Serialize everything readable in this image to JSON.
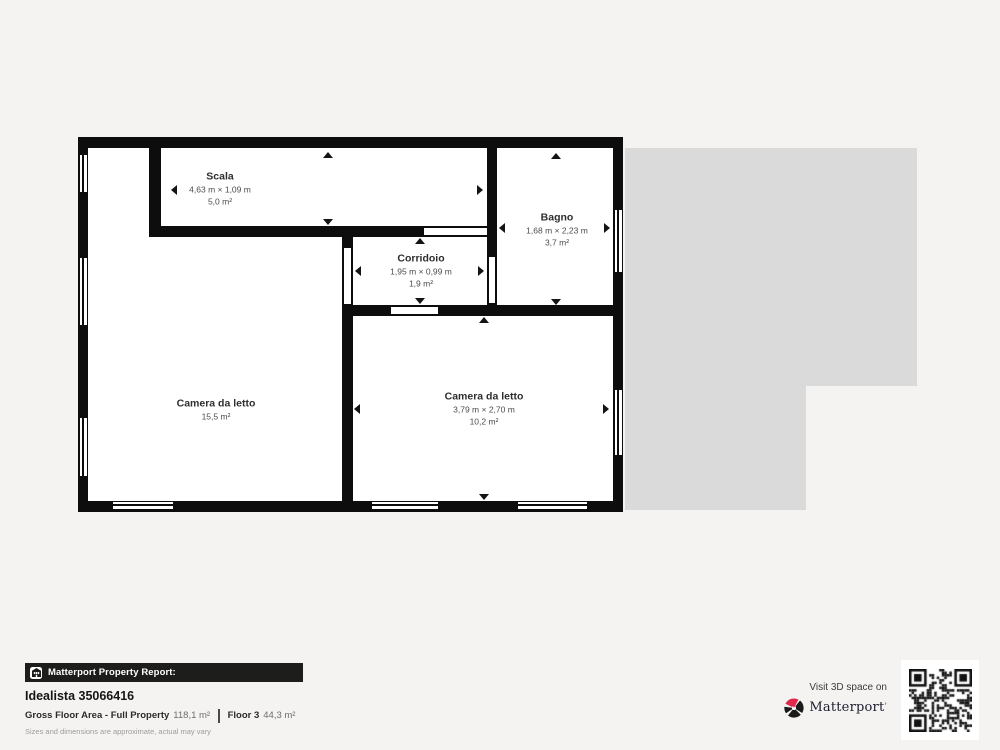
{
  "plan": {
    "rooms": [
      {
        "name": "Scala",
        "dims": "4,63 m × 1,09 m",
        "area": "5,0 m²"
      },
      {
        "name": "Bagno",
        "dims": "1,68 m × 2,23 m",
        "area": "3,7 m²"
      },
      {
        "name": "Corridoio",
        "dims": "1,95 m × 0,99 m",
        "area": "1,9 m²"
      },
      {
        "name": "Camera da letto",
        "area": "15,5 m²"
      },
      {
        "name": "Camera da letto",
        "dims": "3,79 m × 2,70 m",
        "area": "10,2 m²"
      }
    ]
  },
  "footer": {
    "report_label": "Matterport Property Report:",
    "property_id": "Idealista 35066416",
    "gfa_label": "Gross Floor Area - Full Property",
    "gfa_value": "118,1 m²",
    "floor_label": "Floor 3",
    "floor_value": "44,3 m²",
    "disclaimer": "Sizes and dimensions are approximate, actual may vary",
    "visit_text": "Visit 3D space on",
    "brand": "Matterport"
  },
  "colors": {
    "page_bg": "#f4f3f1",
    "wall": "#0d0d0d",
    "room_fill": "#ffffff",
    "building_mass": "#dadada",
    "bar_bg": "#1d1d1b",
    "brand_red": "#e0294a"
  }
}
